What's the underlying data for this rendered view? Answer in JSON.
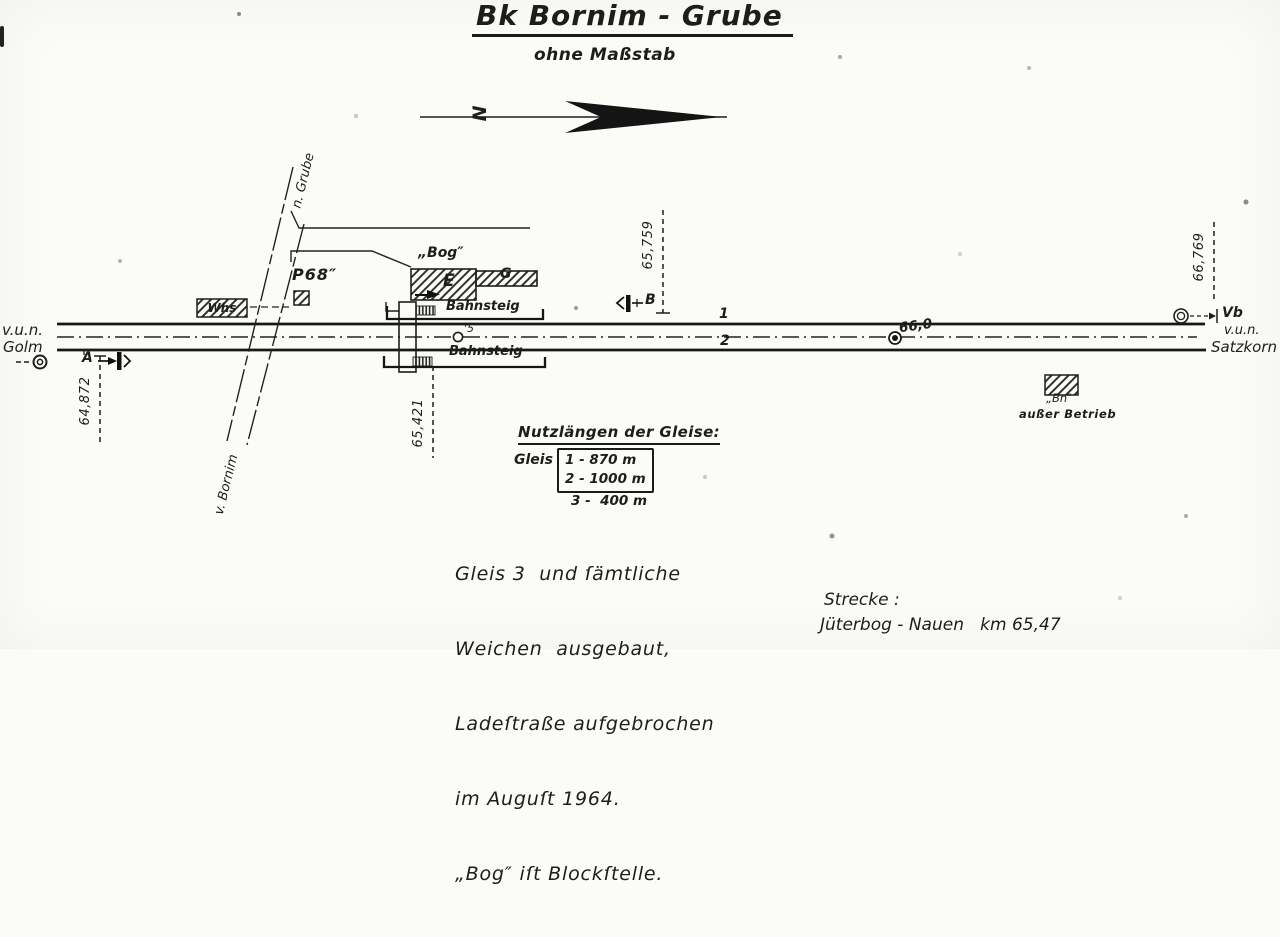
{
  "title": "Bk Bornim - Grube",
  "subtitle": "ohne Maßstab",
  "north": {
    "letter": "N"
  },
  "left_station": {
    "line1": "v.u.n.",
    "line2": "Golm"
  },
  "right_station": {
    "line1": "v.u.n.",
    "line2": "Satzkorn"
  },
  "roads": {
    "to_grube": "n. Grube",
    "from_bornim": "v. Bornim"
  },
  "buildings": {
    "whs": "Whs",
    "p68": "P68″",
    "bog": "„Bog″",
    "e": "E",
    "g": "G",
    "bn": "„Bn″",
    "bn_note": "außer Betrieb"
  },
  "platforms": {
    "top": "Bahnsteig",
    "bottom": "Bahnsteig"
  },
  "tracks": {
    "t1": "1",
    "t2": "2"
  },
  "signals": {
    "a": "A",
    "b": "B",
    "s5": "'5",
    "vb": "Vb"
  },
  "km_marks": {
    "k64872": "64,872",
    "k65421": "65,421",
    "k65759": "65,759",
    "k66769": "66,769",
    "k660": "66,0"
  },
  "legend": {
    "title": "Nutzlängen der Gleise:",
    "gleis_label": "Gleis",
    "rows": [
      "1 - 870 m",
      "2 - 1000 m",
      "3 -  400 m"
    ]
  },
  "note_lines": [
    "Gleis 3  und ſämtliche",
    "Weichen  ausgebaut,",
    "Ladeſtraße aufgebrochen",
    "im Auguſt 1964.",
    "„Bog″ iſt Blockſtelle."
  ],
  "route": {
    "label": "Strecke :",
    "value": "Jüterbog - Nauen   km 65,47"
  },
  "colors": {
    "ink": "#1d1d1d",
    "paper": "#fbfbf8"
  }
}
